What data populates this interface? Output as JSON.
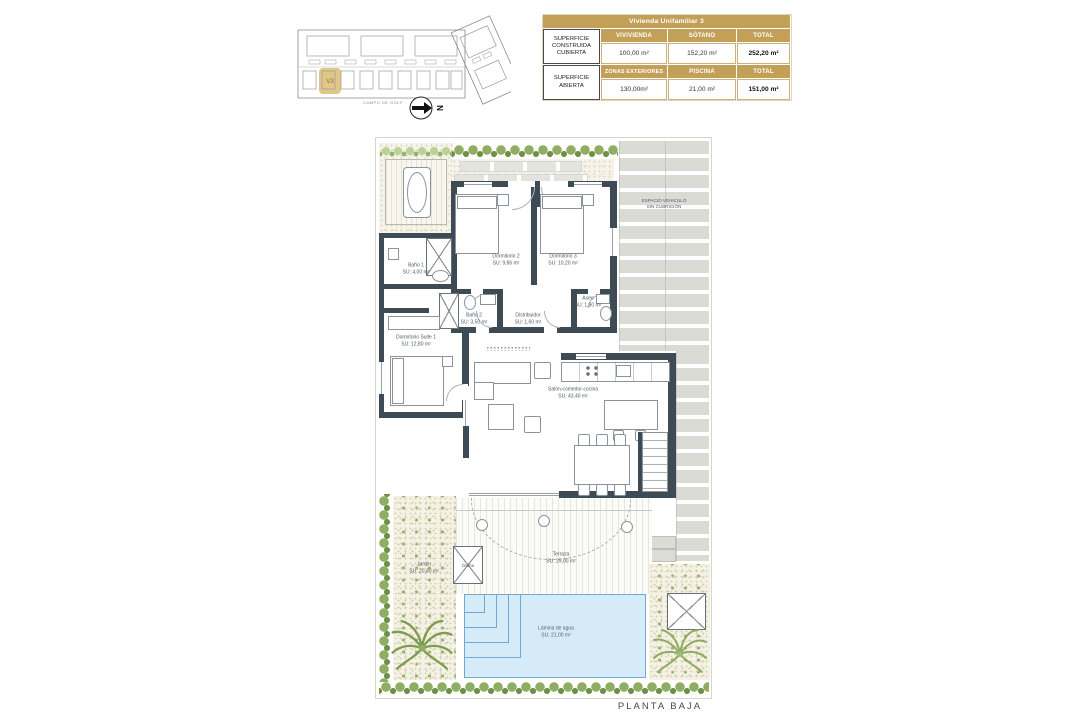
{
  "site_plan": {
    "unit_label": "V3",
    "street_label": "CAMPO DE GOLF",
    "north_label": "N"
  },
  "summary_table": {
    "title": "Vivienda Unifamiliar 3",
    "covered": {
      "label": "SUPERFICIE CONSTRUIDA CUBIERTA",
      "columns": [
        "VIVIVIENDA",
        "SÓTANO",
        "TOTAL"
      ],
      "values": [
        "100,00 m²",
        "152,20 m²",
        "252,20 m²"
      ]
    },
    "open": {
      "label": "SUPERFICIE ABIERTA",
      "columns": [
        "ZONAS EXTERIORES",
        "PISCINA",
        "TOTAL"
      ],
      "values": [
        "130,00m²",
        "21,00 m²",
        "151,00 m²"
      ]
    }
  },
  "plan": {
    "floor_label": "PLANTA BAJA",
    "driveway_label_1": "ESPACIO VEHICULO",
    "driveway_label_2": "SIN CUBRICIÓN",
    "rooms": {
      "bano1": {
        "name": "Baño 1",
        "area": "SU: 4,00 m²"
      },
      "dorm2": {
        "name": "Dormitorio 2",
        "area": "SU: 9,86 m²"
      },
      "dorm3": {
        "name": "Dormitorio 3",
        "area": "SU: 10,20 m²"
      },
      "bano2": {
        "name": "Baño 2",
        "area": "SU: 3,50 m²"
      },
      "distribuidor": {
        "name": "Distribuidor",
        "area": "SU: 1,60 m²"
      },
      "aseo": {
        "name": "Aseo",
        "area": "SU: 1,90 m²"
      },
      "suite": {
        "name": "Dormitorio Suite 1",
        "area": "SU: 12,80 m²"
      },
      "salon": {
        "name": "Salón-comedor-cocina",
        "area": "SU: 43,40 m²"
      },
      "terraza": {
        "name": "Terraza",
        "area": "SU: 29,00 m²"
      },
      "jardin": {
        "name": "Jardín",
        "area": "SU: 20,40 m²"
      },
      "piscina": {
        "name": "Lámina de agua",
        "area": "SU: 21,00 m²"
      },
      "ducha": {
        "name": "Ducha",
        "area": ""
      }
    }
  },
  "colors": {
    "accent_gold": "#c2a057",
    "wall": "#3e4a54",
    "pool": "#d6ebf8",
    "plant": "#6d8f47"
  }
}
